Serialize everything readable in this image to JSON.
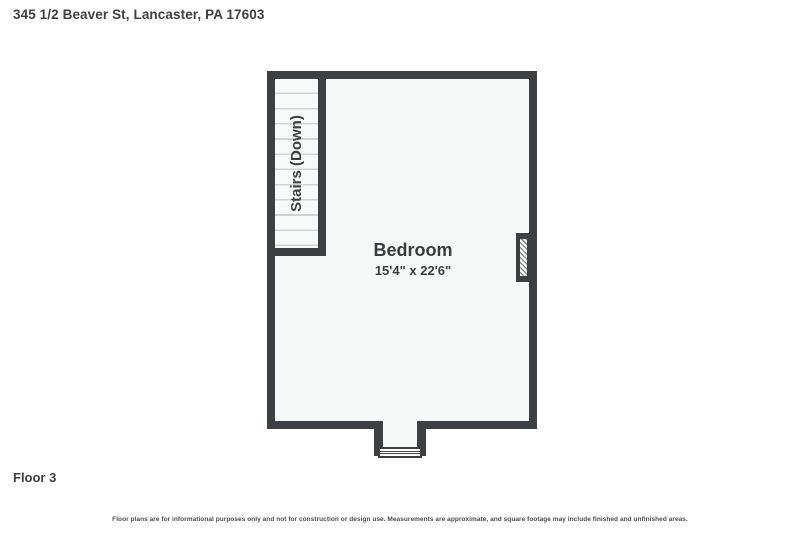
{
  "header": {
    "address": "345 1/2 Beaver St, Lancaster, PA 17603"
  },
  "floor_plan": {
    "room": {
      "name": "Bedroom",
      "dimensions": "15'4\" x 22'6\""
    },
    "stairs": {
      "label": "Stairs (Down)"
    },
    "features": {
      "chimney": "hatched-chimney-symbol",
      "entry_window": "window-symbol"
    },
    "colors": {
      "wall": "#3d4043",
      "interior": "#f7f8f8",
      "stair_tread_line": "#d2d2d2",
      "hatch_line": "#8f8f8f",
      "background": "#ffffff"
    }
  },
  "footer": {
    "floor_label": "Floor 3",
    "disclaimer": "Floor plans are for informational purposes only and not for construction or design use. Measurements are approximate, and square footage may include finished and unfinished areas."
  }
}
